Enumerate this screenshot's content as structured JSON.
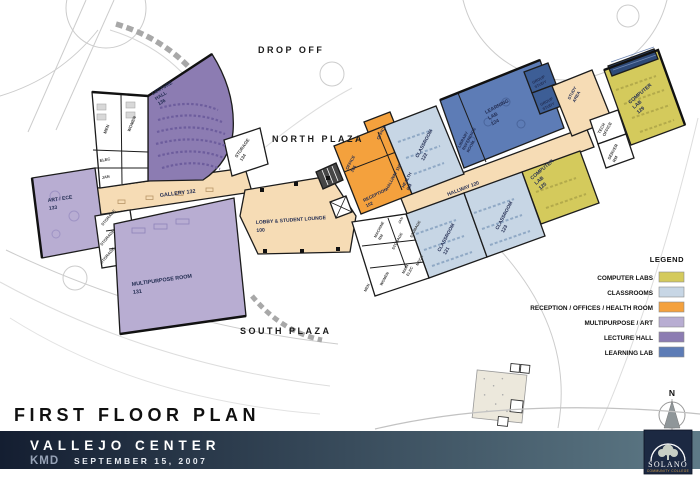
{
  "site": {
    "drop_off": "DROP OFF",
    "north_plaza": "NORTH PLAZA",
    "south_plaza": "SOUTH PLAZA"
  },
  "rooms": {
    "lecture_hall": {
      "name": "LECTURE",
      "name2": "HALL",
      "number": "136"
    },
    "men_w": {
      "name": "MEN"
    },
    "women_w": {
      "name": "WOMEN"
    },
    "elec_w": {
      "name": "ELEC"
    },
    "jan_w": {
      "name": "JAN"
    },
    "storage_134": {
      "name": "STORAGE",
      "number": "134"
    },
    "gallery": {
      "name": "GALLERY 132"
    },
    "art_ece": {
      "name": "ART / ECE",
      "number": "133"
    },
    "storage_w1": {
      "name": "STORAGE"
    },
    "storage_w2": {
      "name": "STORAGE"
    },
    "storage_w3": {
      "name": "STORAGE"
    },
    "multipurpose": {
      "name": "MULTIPURPOSE ROOM",
      "number": "131"
    },
    "lobby": {
      "name": "LOBBY & STUDENT LOUNGE",
      "number": "100"
    },
    "office_top": {
      "name": "OFFICE"
    },
    "office_104": {
      "name": "OFFICE",
      "number": "104"
    },
    "reception": {
      "name": "RECEPTION",
      "number": "102"
    },
    "hallway_110": {
      "name": "HALLWAY 110"
    },
    "health_rm": {
      "name": "HEALTH",
      "name2": "RM"
    },
    "classroom_122": {
      "name": "CLASSROOM",
      "number": "122"
    },
    "library_ref": {
      "name": "LIBRARY",
      "name2": "REFERENCE",
      "name3": "ROOM"
    },
    "learning_lab": {
      "name": "LEARNING",
      "name2": "LAB",
      "number": "124"
    },
    "group_study_1": {
      "name": "GROUP",
      "name2": "STUDY"
    },
    "group_study_2": {
      "name": "GROUP",
      "name2": "STUDY"
    },
    "study_area": {
      "name": "STUDY",
      "name2": "AREA"
    },
    "tech_office": {
      "name": "TECH",
      "name2": "OFFICE"
    },
    "server_rm": {
      "name": "SERVER",
      "name2": "RM"
    },
    "computer_lab_129": {
      "name": "COMPUTER",
      "name2": "LAB",
      "number": "129"
    },
    "computer_lab_125": {
      "name": "COMPUTER",
      "name2": "LAB",
      "number": "125"
    },
    "hallway_120": {
      "name": "HALLWAY 120"
    },
    "classroom_121": {
      "name": "CLASSROOM",
      "number": "121"
    },
    "classroom_123": {
      "name": "CLASSROOM",
      "number": "123"
    },
    "machine_rm": {
      "name": "MACHINE",
      "name2": "RM"
    },
    "storage_e1": {
      "name": "STORAGE"
    },
    "storage_e2": {
      "name": "STORAGE"
    },
    "jan_e": {
      "name": "JAN"
    },
    "main_elec": {
      "name": "MAIN",
      "name2": "ELEC"
    },
    "mech": {
      "name": "MECH"
    },
    "men_e": {
      "name": "MEN"
    },
    "women_e": {
      "name": "WOMEN"
    }
  },
  "legend": {
    "title": "LEGEND",
    "items": [
      {
        "label": "COMPUTER LABS",
        "color": "#d4ca5c"
      },
      {
        "label": "CLASSROOMS",
        "color": "#c7d6e5"
      },
      {
        "label": "RECEPTION / OFFICES / HEALTH ROOM",
        "color": "#f4a13d"
      },
      {
        "label": "MULTIPURPOSE / ART",
        "color": "#b8add2"
      },
      {
        "label": "LECTURE HALL",
        "color": "#8c7cb2"
      },
      {
        "label": "LEARNING LAB",
        "color": "#5d7cb6"
      }
    ]
  },
  "palette": {
    "corridor": "#f6dcb5",
    "classroom": "#c7d6e5",
    "computer_lab": "#d4ca5c",
    "reception_office": "#f4a13d",
    "multipurpose_art": "#b8add2",
    "lecture_hall": "#8c7cb2",
    "learning_lab": "#5d7cb6",
    "group_study": "#3d5e96",
    "white_room": "#ffffff",
    "banner_left": "#141e31",
    "banner_right": "#5e7a87",
    "logo_box": "#1c2942"
  },
  "titleblock": {
    "plan_title": "FIRST FLOOR PLAN",
    "project": "VALLEJO CENTER",
    "firm": "KMD",
    "date": "SEPTEMBER 15, 2007"
  },
  "logo": {
    "name": "SOLANO",
    "tagline": "COMMUNITY COLLEGE"
  },
  "compass": {
    "label": "N"
  }
}
